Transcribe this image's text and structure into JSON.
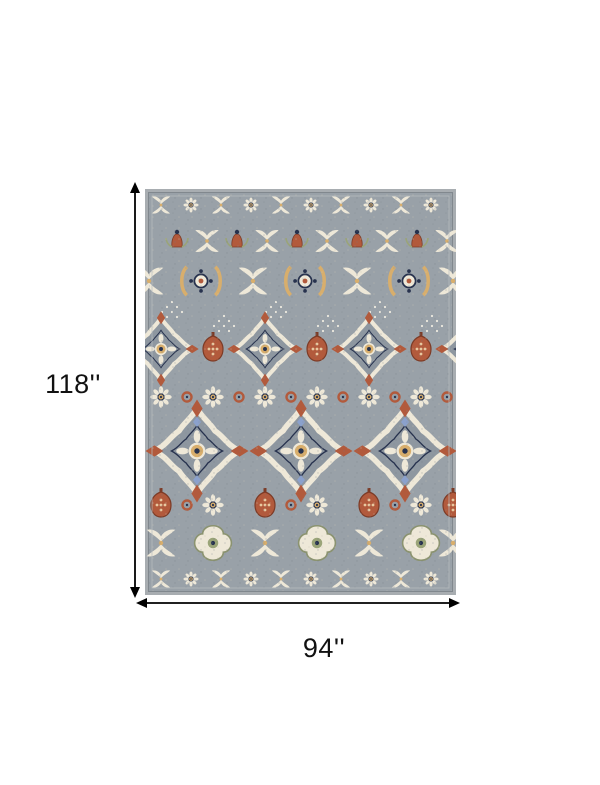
{
  "page": {
    "background": "#ffffff"
  },
  "diagram": {
    "item": "area-rug",
    "dimensions": {
      "height_label": "118''",
      "width_label": "94''"
    },
    "arrow_color": "#000000",
    "label_color": "#111111",
    "rug_colors": {
      "field_gray": "#99a1a8",
      "edge_gray": "#a8adb1",
      "cream": "#eee8d8",
      "navy": "#27324e",
      "rust": "#b25a3c",
      "gold": "#d8ae6c",
      "light_blue": "#8ba1cc",
      "sage": "#9aa478"
    }
  }
}
